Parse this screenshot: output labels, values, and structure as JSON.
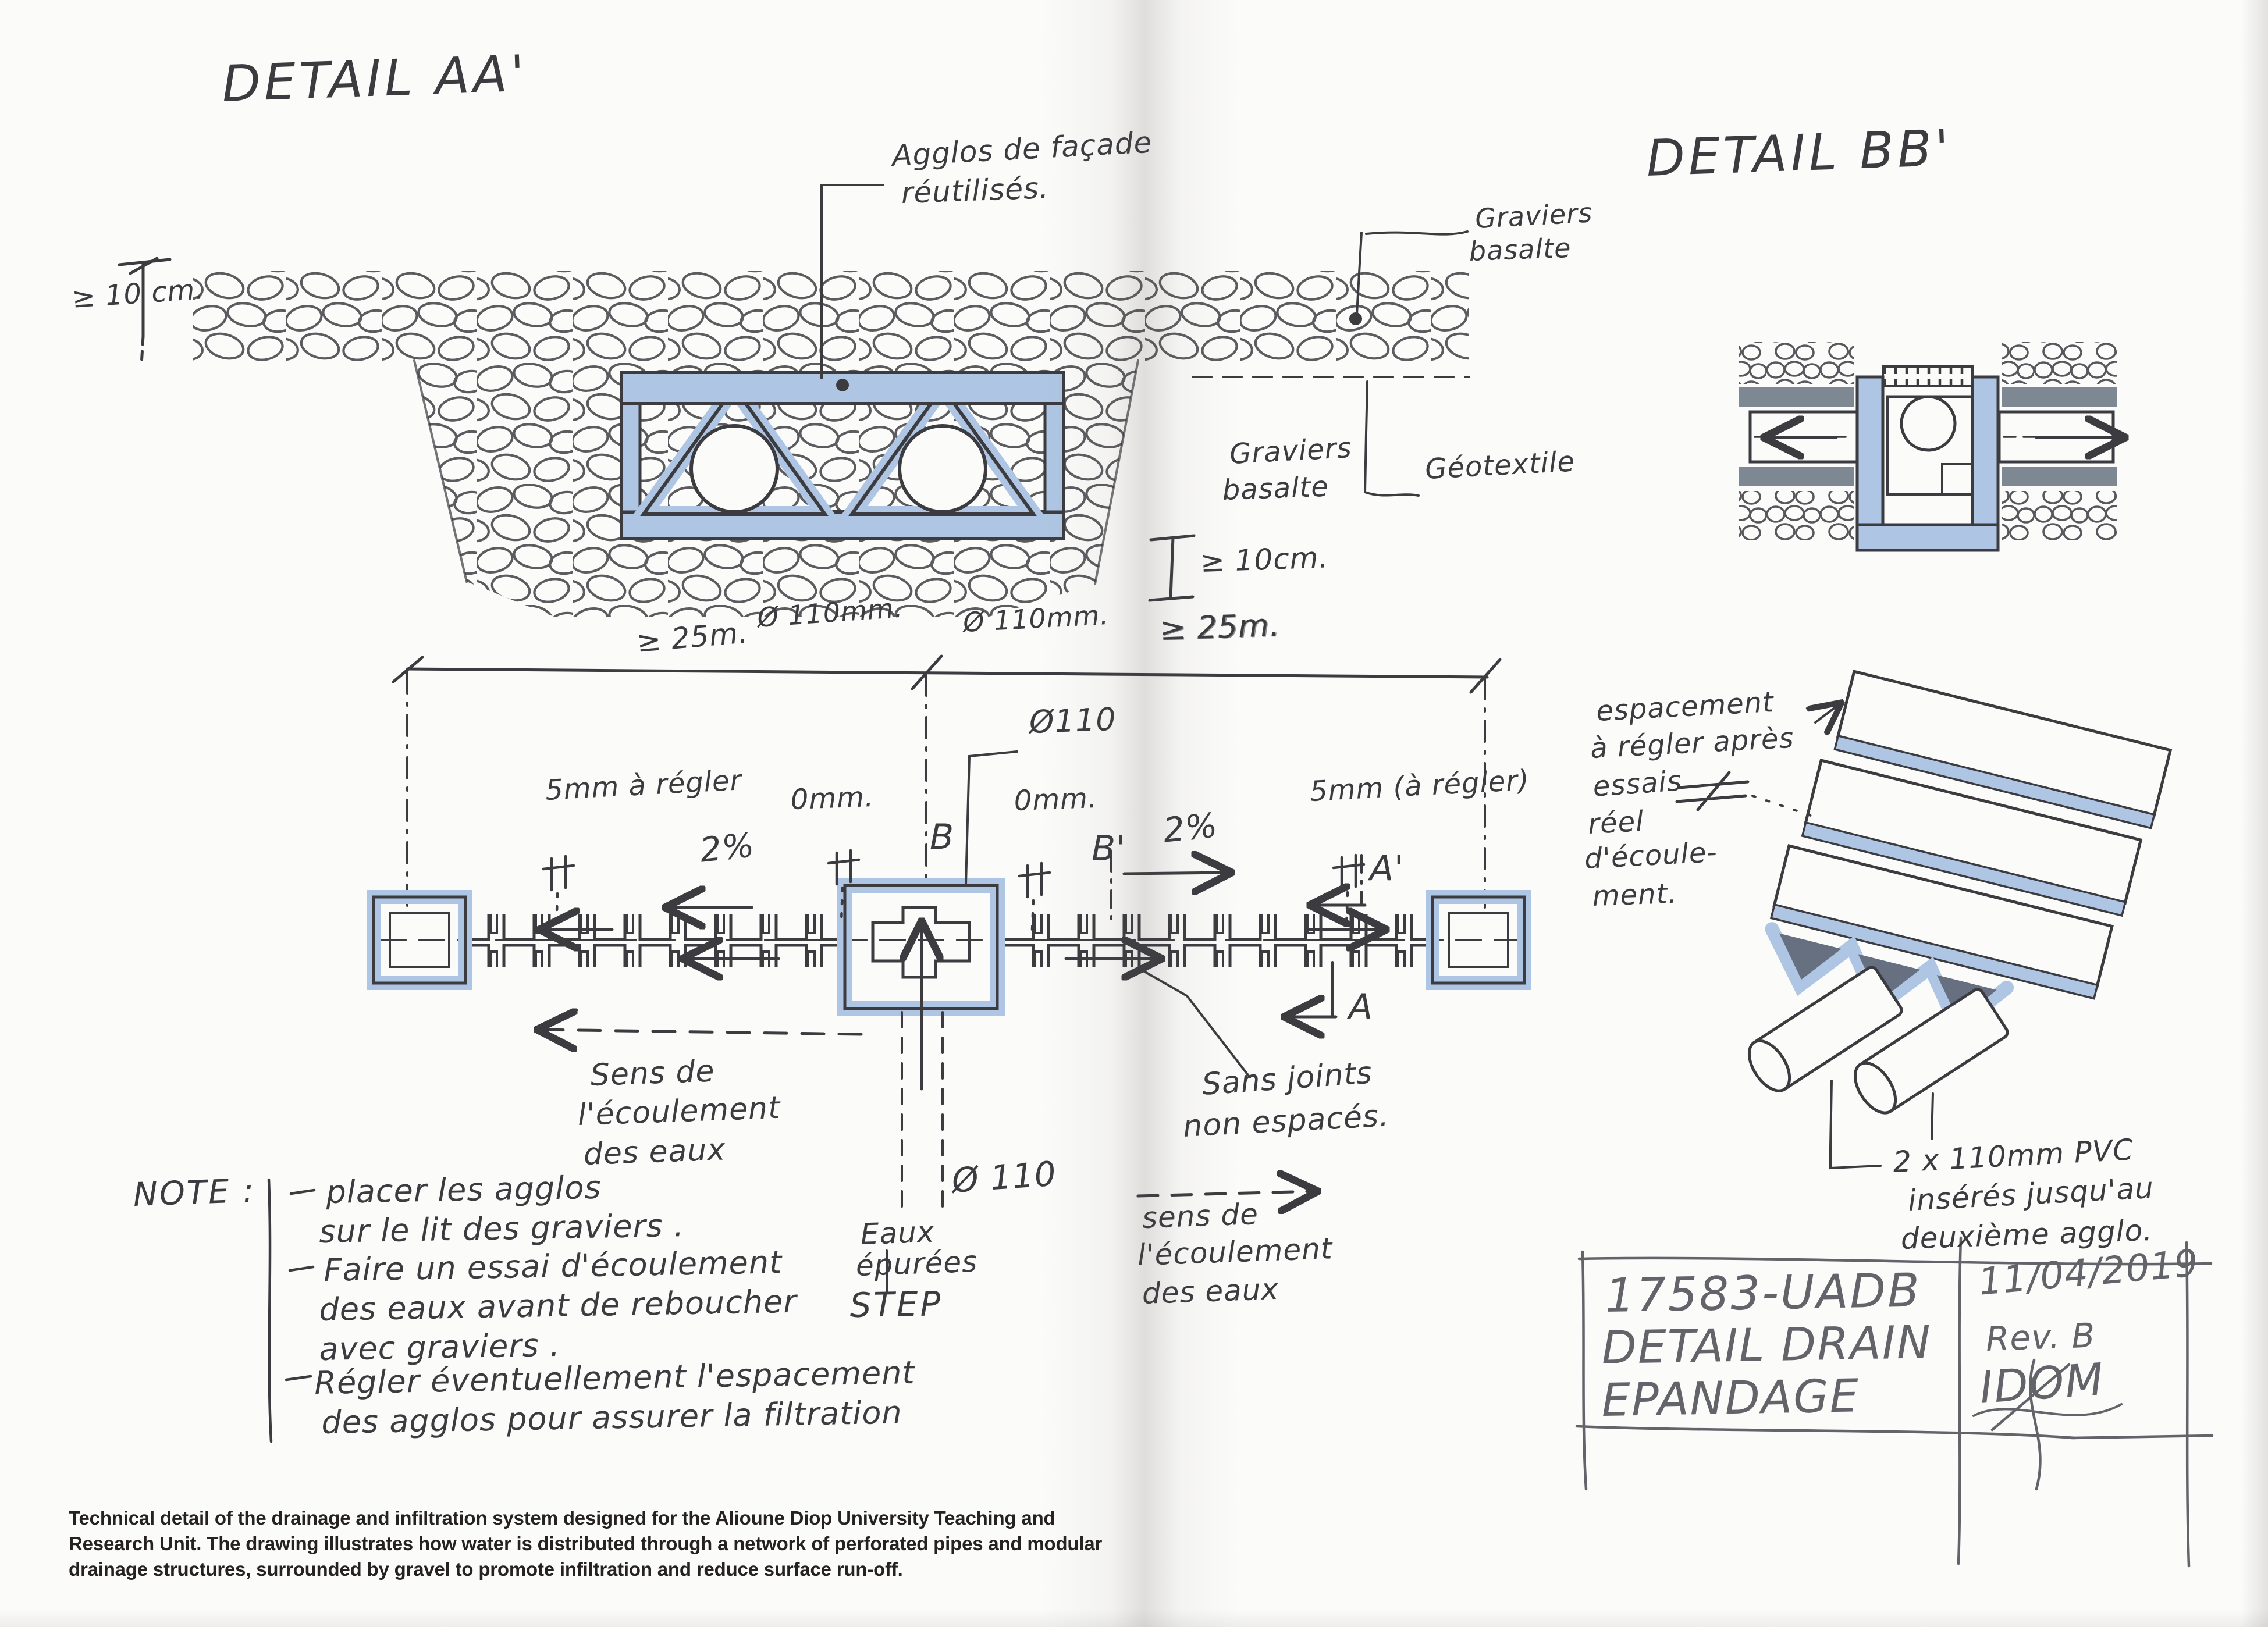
{
  "colors": {
    "ink": "#3b3b40",
    "pencil": "#63636a",
    "marker_blue": "#aec6e3",
    "marker_gray": "#7e8893",
    "paper": "#fbfbfa",
    "caption_ink": "#262223"
  },
  "left": {
    "title": "DETAIL AA'",
    "section": {
      "agglos": [
        "Agglos de façade",
        "réutilisés."
      ],
      "graviers_top": [
        "Graviers",
        "basalte"
      ],
      "graviers_mid": [
        "Graviers",
        "basalte"
      ],
      "geotextile": "Géotextile",
      "dim_cover": "≥ 10 cm.",
      "dim_cover_right": "≥ 10cm.",
      "dim_spacing_right": "≥ 25m.",
      "dim_spacing_left": "≥ 25m.",
      "pipe_dia_1": "Ø 110mm.",
      "pipe_dia_2": "Ø 110mm."
    },
    "plan": {
      "pipe_dia_top": "Ø110",
      "gap_left": "5mm à régler",
      "gap_zero_1": "0mm.",
      "gap_zero_2": "0mm.",
      "gap_right": "5mm (à régler)",
      "slope_left": "2%",
      "slope_right": "2%",
      "sec_b": "B",
      "sec_b_prime": "B'",
      "sec_a_prime": "A'",
      "sec_a": "A",
      "flow_left": [
        "Sens de",
        "l'écoulement",
        "des eaux"
      ],
      "flow_right": [
        "sens de",
        "l'écoulement",
        "des eaux"
      ],
      "joints": [
        "Sans joints",
        "non espacés."
      ],
      "pipe_dia_bottom": "Ø 110",
      "source": [
        "Eaux",
        "épurées",
        "STEP"
      ]
    },
    "note": {
      "heading": "NOTE :",
      "lines": [
        "placer les agglos",
        "sur le lit des graviers .",
        "Faire un essai d'écoulement",
        "des eaux avant de reboucher",
        "avec graviers .",
        "Régler éventuellement l'espacement",
        "des agglos pour assurer la filtration"
      ]
    }
  },
  "right": {
    "title": "DETAIL BB'",
    "spacing_note": [
      "espacement",
      "à régler après",
      "essais",
      "réel",
      "d'écoule-",
      "ment."
    ],
    "pvc_note": [
      "2 x 110mm PVC",
      "insérés jusqu'au",
      "deuxième agglo."
    ],
    "titleblock": {
      "project": "17583-UADB",
      "date": "11/04/2019",
      "drawing_1": "DETAIL DRAIN",
      "rev": "Rev. B",
      "drawing_2": "EPANDAGE",
      "firm": "IDOM"
    }
  },
  "caption": {
    "lines": [
      "Technical detail of the drainage and infiltration system designed for the Alioune Diop University Teaching and",
      "Research Unit. The drawing illustrates how water is distributed through a network of perforated pipes and modular",
      "drainage structures, surrounded by gravel to promote infiltration and reduce surface run-off."
    ]
  }
}
